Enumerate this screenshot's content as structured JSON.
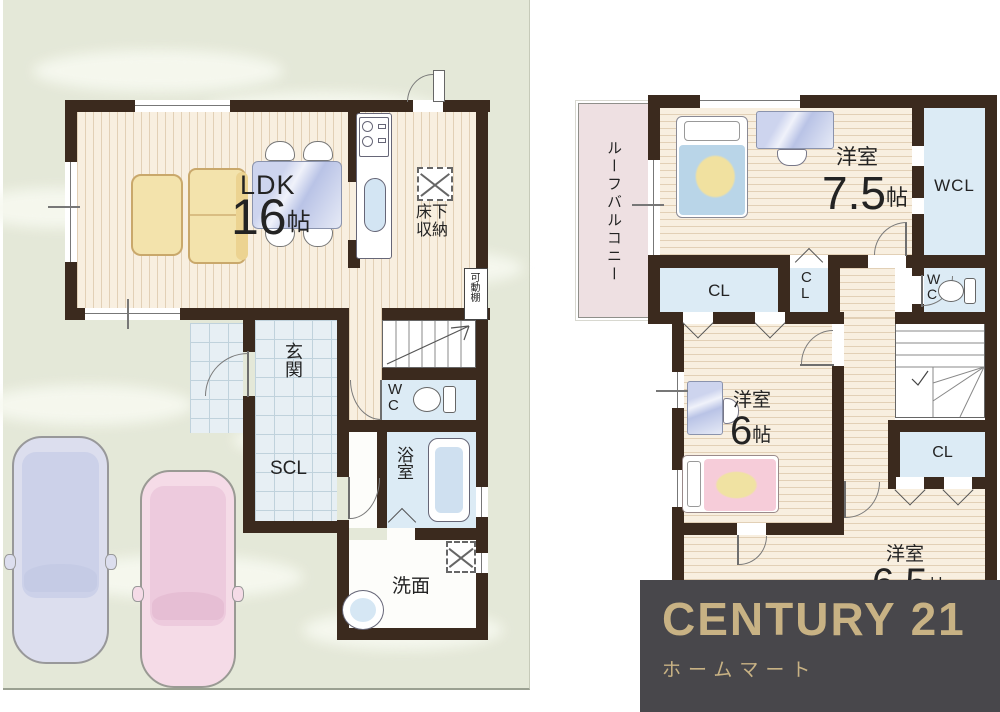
{
  "document": {
    "type": "real-estate floor plan flyer"
  },
  "floor1": {
    "ldk": {
      "name": "LDK",
      "num": "16",
      "unit": "帖"
    },
    "underfloor": "床下\n収納",
    "shelf": "可動棚",
    "entrance": "玄関",
    "shoe_closet": "SCL",
    "wc": "WC",
    "bath": "浴室",
    "washroom": "洗面"
  },
  "floor2": {
    "balcony": "ルーフバルコニー",
    "room1": {
      "name": "洋室",
      "num": "7.5",
      "unit": "帖"
    },
    "wcl": "WCL",
    "closet_a": "CL",
    "closet_b": "CL",
    "wc": "WC",
    "room2": {
      "name": "洋室",
      "num": "6",
      "unit": "帖"
    },
    "closet_c": "CL",
    "room3": {
      "name": "洋室",
      "num": "6.5",
      "unit": "帖"
    }
  },
  "logo": {
    "brand": "CENTURY 21",
    "company": "ホームマート"
  },
  "colors": {
    "wall": "#3b2a1e",
    "wood_floor": "#f8efe0",
    "closet_blue": "#dcebf5",
    "tile_blue": "#e7eff4",
    "balcony_pink": "#eee0e2",
    "background_green": "#e4e8d8",
    "logo_background": "#48474b",
    "logo_gold": "#c8b284",
    "car_blue": "#dcdeee",
    "car_pink": "#f5dbe7"
  }
}
